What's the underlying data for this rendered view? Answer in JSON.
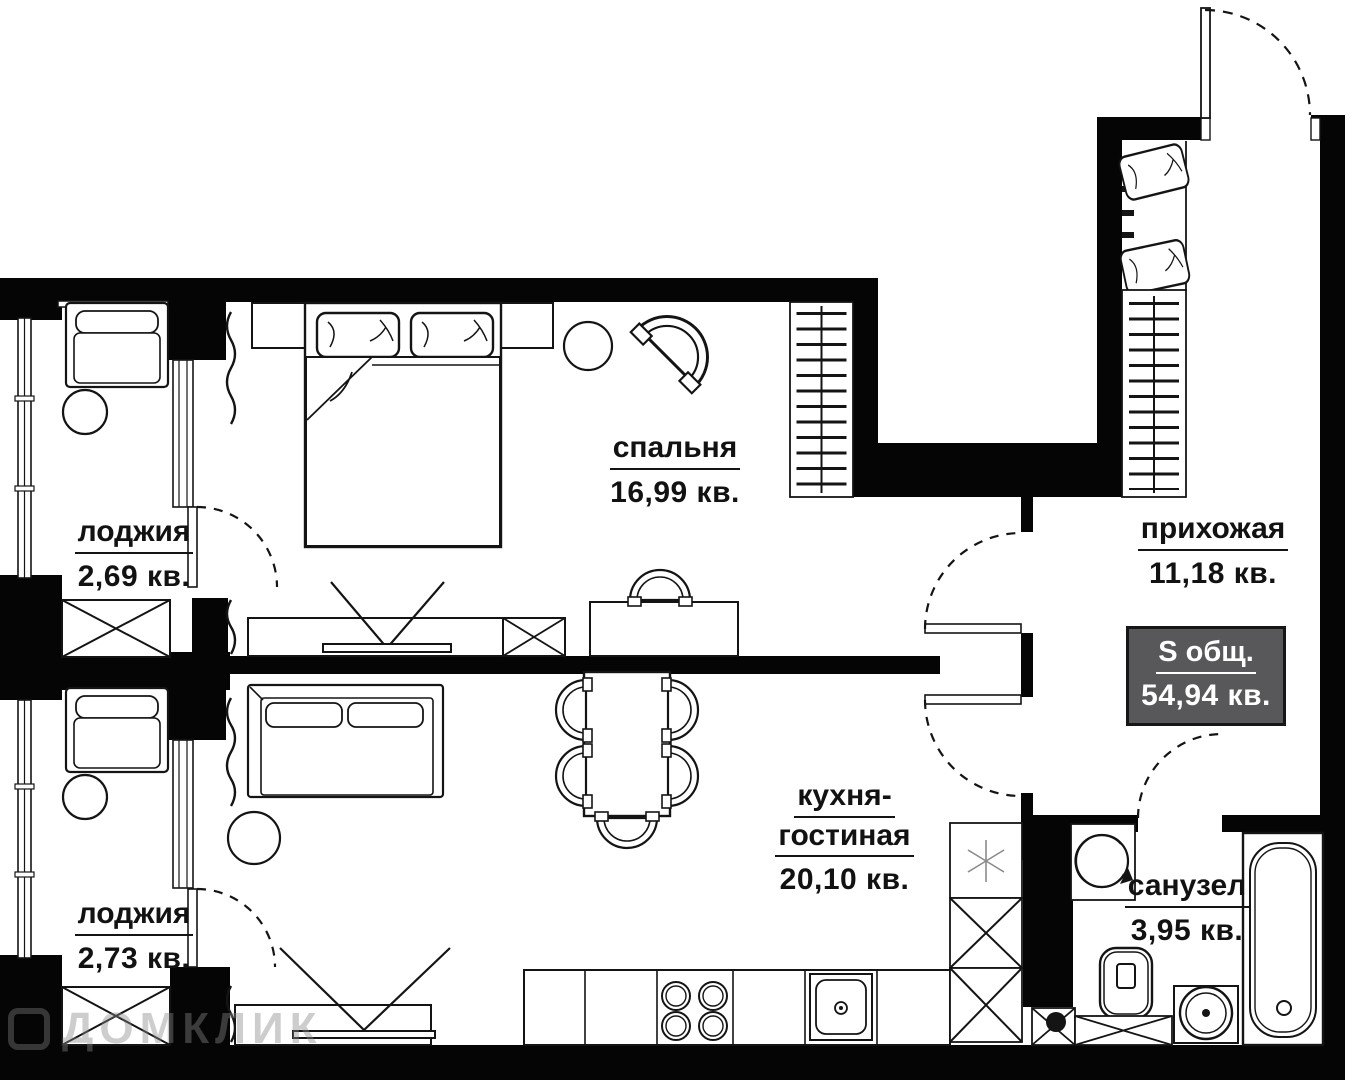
{
  "plan": {
    "rooms": {
      "bedroom": {
        "name": "спальня",
        "area": "16,99 кв."
      },
      "loggia_top": {
        "name": "лоджия",
        "area": "2,69 кв."
      },
      "loggia_bottom": {
        "name": "лоджия",
        "area": "2,73 кв."
      },
      "kitchen_living": {
        "name_line1": "кухня-",
        "name_line2": "гостиная",
        "area": "20,10 кв."
      },
      "hallway": {
        "name": "прихожая",
        "area": "11,18 кв."
      },
      "bathroom": {
        "name": "санузел",
        "area": "3,95 кв."
      }
    },
    "total": {
      "label": "S общ.",
      "value": "54,94 кв."
    },
    "watermark": "ДОМКЛИК",
    "colors": {
      "wall": "#050505",
      "line": "#141414",
      "badge_bg": "#58585a",
      "badge_text": "#ffffff",
      "background": "#ffffff"
    }
  }
}
